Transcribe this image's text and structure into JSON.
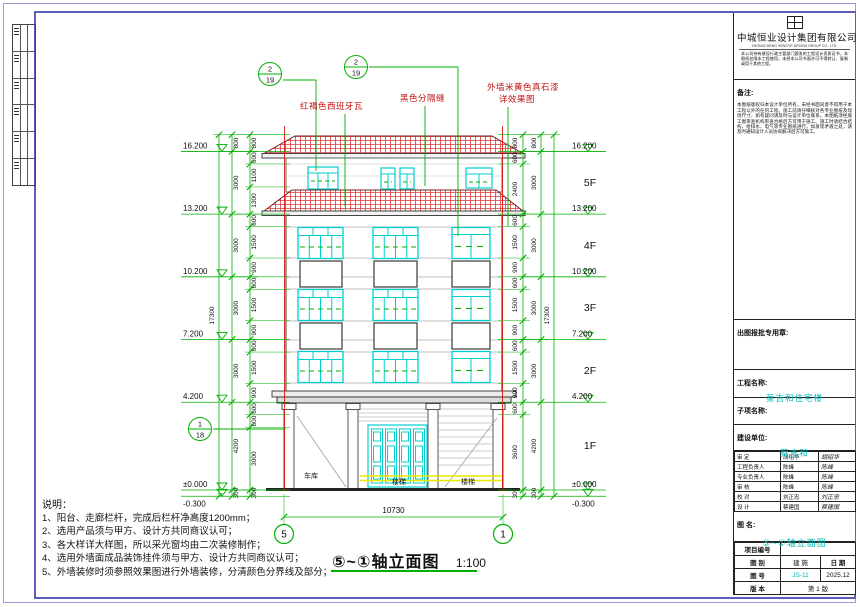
{
  "drawing_title": {
    "name": "⑤~①轴立面图",
    "scale": "1:100"
  },
  "elevation": {
    "levels": [
      {
        "label": "16.200",
        "h": 16200
      },
      {
        "label": "13.200",
        "h": 13200
      },
      {
        "label": "10.200",
        "h": 10200
      },
      {
        "label": "7.200",
        "h": 7200
      },
      {
        "label": "4.200",
        "h": 4200
      },
      {
        "label": "±0.000",
        "h": 0
      },
      {
        "label": "-0.300",
        "h": -300
      }
    ],
    "floor_labels": [
      "5F",
      "4F",
      "3F",
      "2F",
      "1F"
    ],
    "chains": {
      "left_inner": [
        300,
        3000,
        600,
        600,
        900,
        1500,
        600,
        900,
        1500,
        600,
        900,
        1500,
        600,
        1300,
        1100,
        600,
        800
      ],
      "left_outer": [
        300,
        4200,
        3000,
        3000,
        3000,
        3000,
        800
      ],
      "left_total": [
        17300
      ],
      "right_inner": [
        300,
        3600,
        600,
        900,
        1500,
        600,
        900,
        1500,
        600,
        900,
        1500,
        600,
        2400,
        600,
        800
      ],
      "right_outer": [
        300,
        4200,
        3000,
        3000,
        3000,
        3000,
        800
      ],
      "right_total": [
        17300
      ]
    },
    "total_width": "10730",
    "axis_bubbles": [
      {
        "label": "5"
      },
      {
        "label": "1"
      }
    ],
    "detail_bubbles": [
      {
        "top": "2",
        "bottom": "19"
      },
      {
        "top": "2",
        "bottom": "19"
      },
      {
        "top": "1",
        "bottom": "18"
      }
    ],
    "annotations": {
      "tile": "红褐色西班牙瓦",
      "seam": "黑色分隔缝",
      "paint_line1": "外墙米黄色真石漆",
      "paint_line2": "详效果图"
    },
    "room_labels": {
      "garage": "车库",
      "entry": "楼梯",
      "shop": "楼梯"
    }
  },
  "notes": {
    "title": "说明：",
    "items": [
      "1、阳台、走廊栏杆，完成后栏杆净高度1200mm；",
      "2、选用产品须与甲方、设计方共同商议认可；",
      "3、各大样详大样图，所以采光窗均由二次装修制作；",
      "4、选用外墙面成品装饰挂件须与甲方、设计方共同商议认可；",
      "5、外墙装修时须参照效果图进行外墙装修，分清颜色分界线及部分；"
    ]
  },
  "title_block": {
    "company": "中城恒业设计集团有限公司",
    "company_en": "ZHONGCHENG HENGYE DESIGN GROUP CO., LTD.",
    "cert_text": "本公司持有建设行政主管部门颁发的工程设计资质证书，本图纸仅限本工程使用，未经本公司书面许可不得转让、复制或用于其他工程。",
    "remark_label": "备注:",
    "remark_text": "本图纸版权归本设计单位所有，未经书面同意不得用于本工程以外的任何工程。施工前请仔细核对各专业图纸及现场尺寸，如有疑问请及时与设计单位联系。本图纸须经施工图审查机构审查合格后方可用于施工。施工时请结合结构、给排水、电气等专业图纸进行，如发现矛盾之处，请及时通知设计人员协商解决后方可施工。",
    "stamp_label": "出图报批专用章:",
    "project_label": "工程名称:",
    "project_name": "蔡吉和住宅楼",
    "sub_label": "子项名称:",
    "client_label": "建设单位:",
    "client_name": "蔡吉和",
    "sign_rows": [
      {
        "role": "审    定",
        "name": "胡绍华",
        "sig": "胡绍华"
      },
      {
        "role": "工程负责人",
        "name": "陈峰",
        "sig": "陈峰"
      },
      {
        "role": "专业负责人",
        "name": "陈峰",
        "sig": "陈峰"
      },
      {
        "role": "审    核",
        "name": "陈峰",
        "sig": "陈峰"
      },
      {
        "role": "校    对",
        "name": "刘正忠",
        "sig": "刘正忠"
      },
      {
        "role": "设    计",
        "name": "蔡建国",
        "sig": "蔡建国"
      }
    ],
    "drawing_name_label": "图  名:",
    "drawing_name": "⑤~①轴立面图",
    "project_no_label": "项目编号",
    "category_label": "图  别",
    "category": "建  施",
    "date_label": "日  期",
    "date": "2025.12",
    "no_label": "图  号",
    "no": "JS-11",
    "version_label": "版  本",
    "version": "第 1 版"
  }
}
